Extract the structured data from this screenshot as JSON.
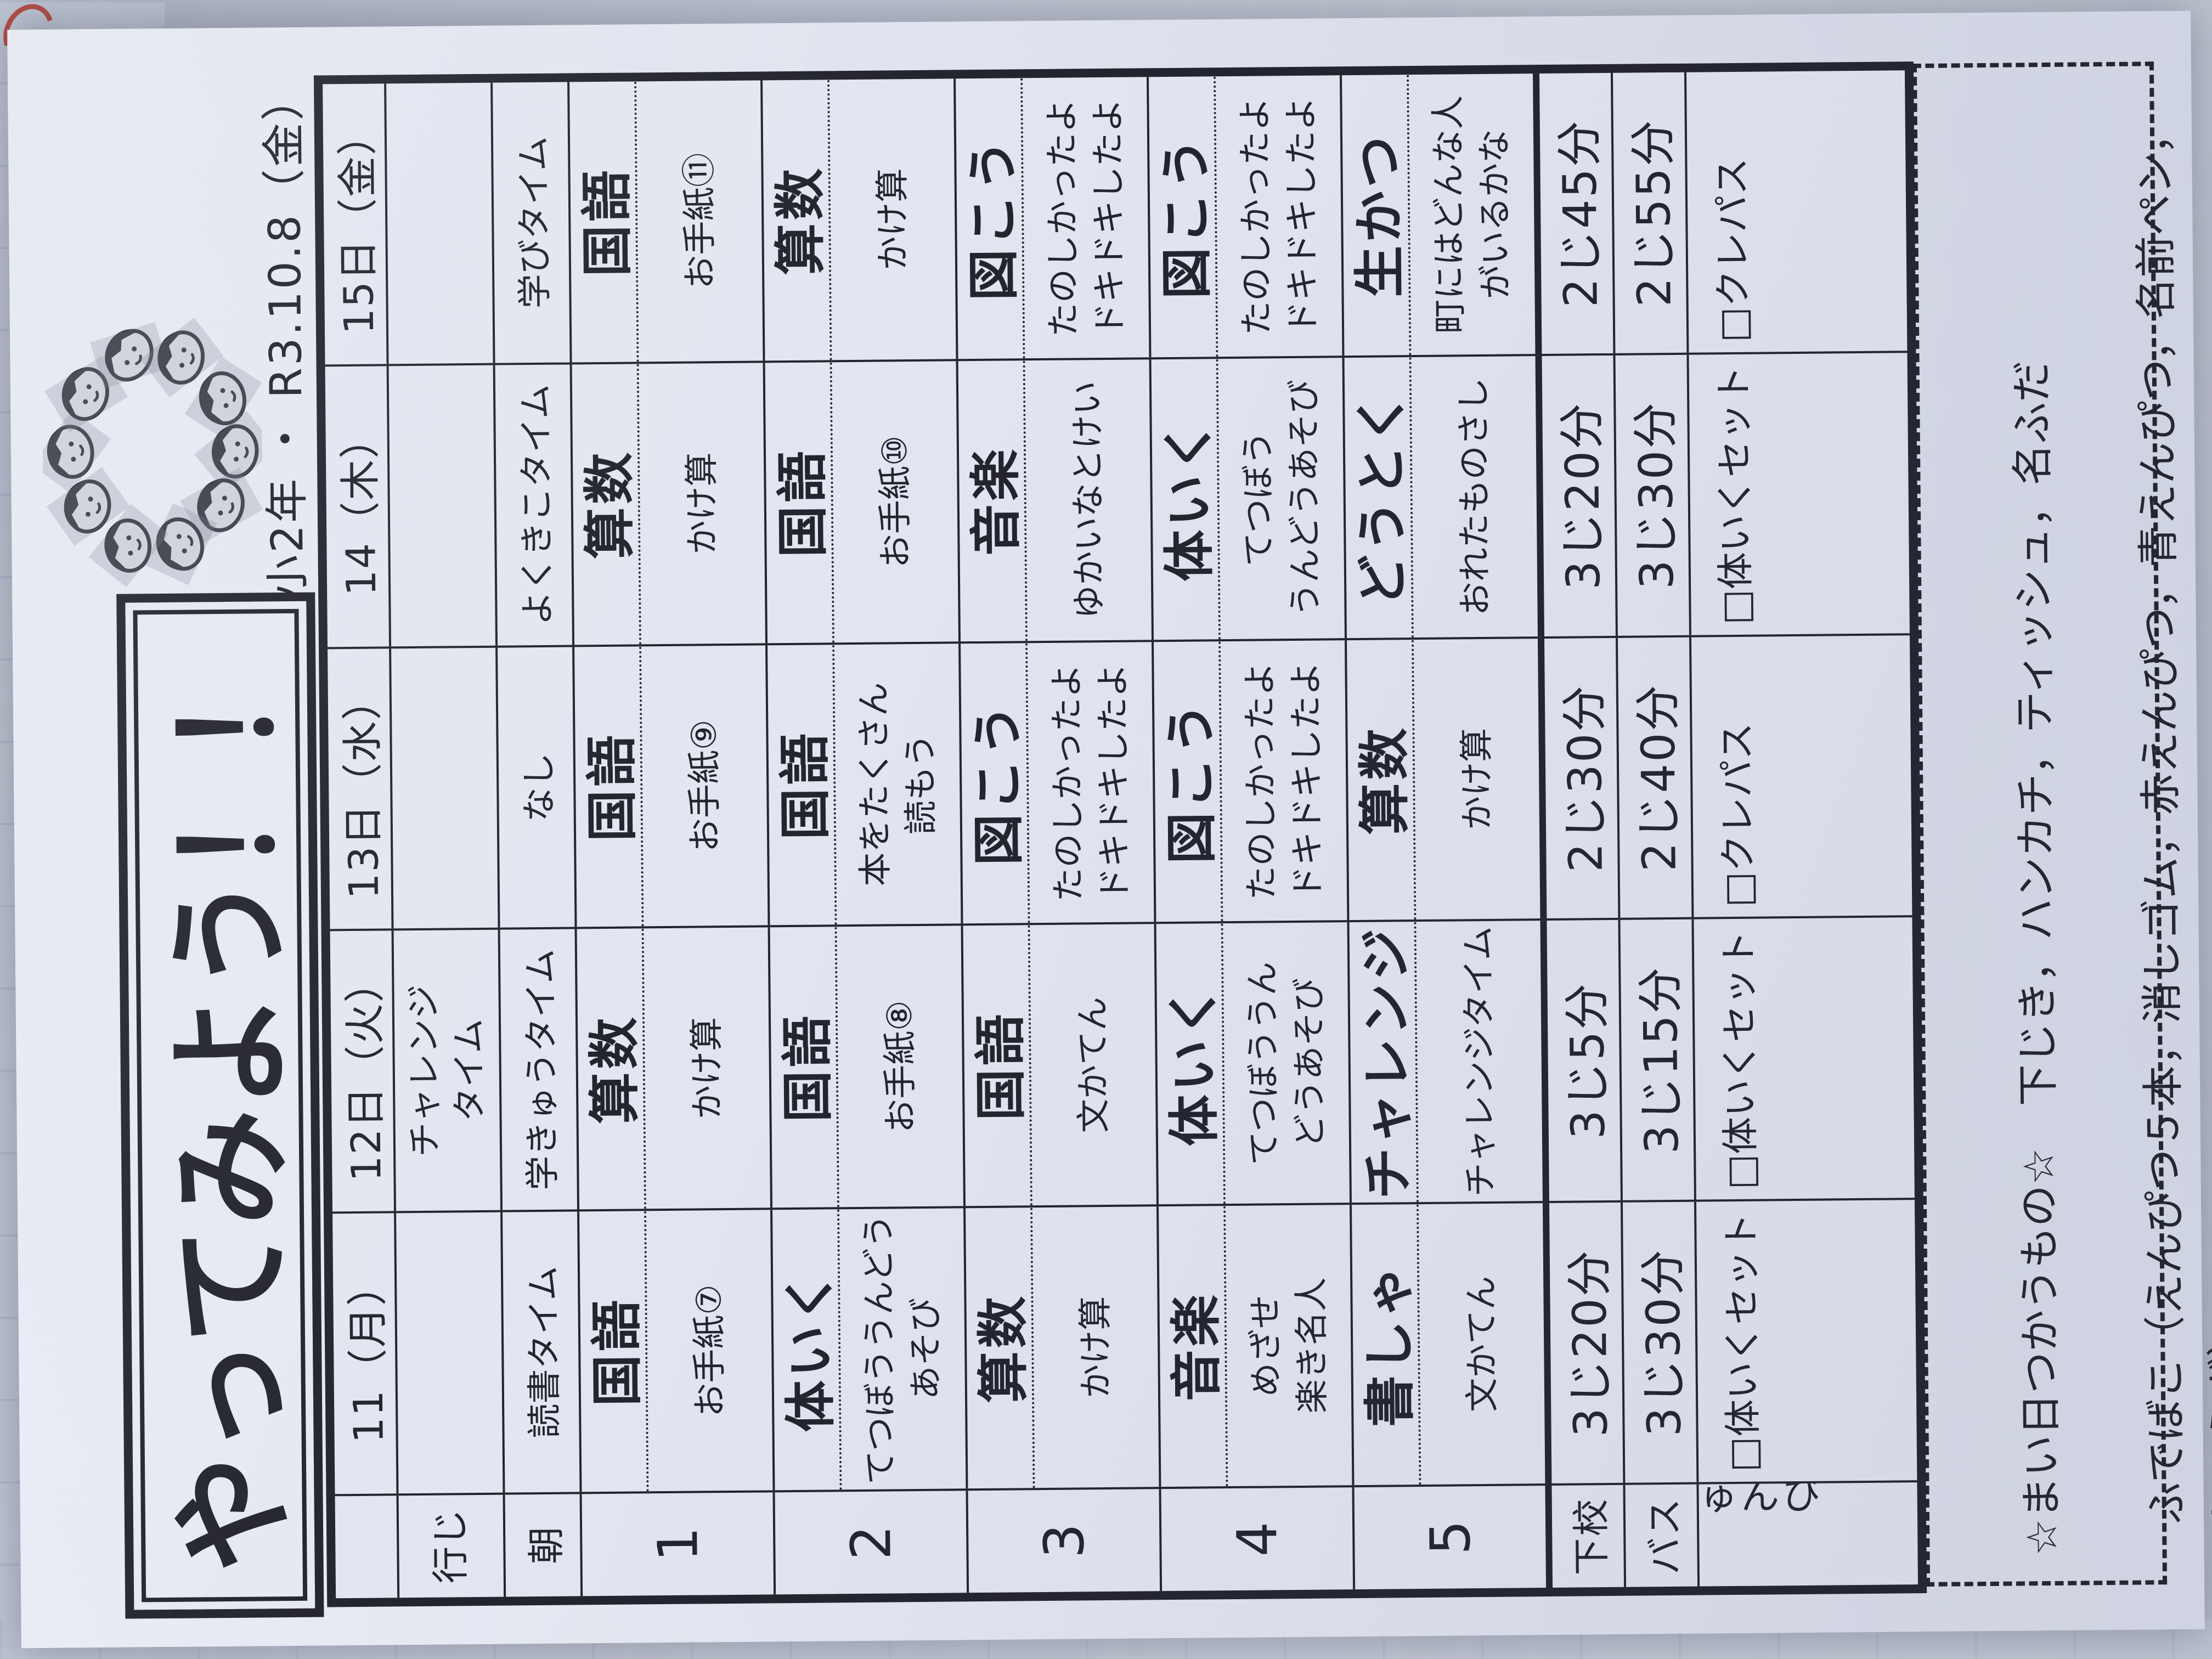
{
  "page": {
    "title": "やってみよう！！",
    "school_line": "本渡東小2年 ・ R3.10.8（金）",
    "logo_icon": "kids-faces-ring-icon"
  },
  "table": {
    "corner_label": "",
    "row_headers": [
      "行じ",
      "朝",
      "1",
      "2",
      "3",
      "4",
      "5",
      "下校",
      "バス",
      "じゅんび"
    ],
    "days": [
      {
        "label": "11（月）",
        "gyoji": "",
        "asa": "読書タイム",
        "periods": [
          {
            "subject": "国語",
            "detail": "お手紙⑦"
          },
          {
            "subject": "体いく",
            "detail": "てつぼううんどう\nあそび"
          },
          {
            "subject": "算数",
            "detail": "かけ算"
          },
          {
            "subject": "音楽",
            "detail": "めざせ\n楽き名人"
          },
          {
            "subject": "書しゃ",
            "detail": "文かてん"
          }
        ],
        "gekou": "3じ20分",
        "bus": "3じ30分",
        "junbi": "□体いくセット"
      },
      {
        "label": "12日（火）",
        "gyoji": "チャレンジ\nタイム",
        "asa": "学きゅうタイム",
        "periods": [
          {
            "subject": "算数",
            "detail": "かけ算"
          },
          {
            "subject": "国語",
            "detail": "お手紙⑧"
          },
          {
            "subject": "国語",
            "detail": "文かてん"
          },
          {
            "subject": "体いく",
            "detail": "てつぼううん\nどうあそび"
          },
          {
            "subject": "チャレンジ",
            "detail": "チャレンジタイム"
          }
        ],
        "gekou": "3じ5分",
        "bus": "3じ15分",
        "junbi": "□体いくセット"
      },
      {
        "label": "13日（水）",
        "gyoji": "",
        "asa": "なし",
        "periods": [
          {
            "subject": "国語",
            "detail": "お手紙⑨"
          },
          {
            "subject": "国語",
            "detail": "本をたくさん\n読もう"
          },
          {
            "subject": "図こう",
            "detail": "たのしかったよ\nドキドキしたよ"
          },
          {
            "subject": "図こう",
            "detail": "たのしかったよ\nドキドキしたよ"
          },
          {
            "subject": "算数",
            "detail": "かけ算"
          }
        ],
        "gekou": "2じ30分",
        "bus": "2じ40分",
        "junbi": "□クレパス"
      },
      {
        "label": "14（木）",
        "gyoji": "",
        "asa": "よくきこタイム",
        "periods": [
          {
            "subject": "算数",
            "detail": "かけ算"
          },
          {
            "subject": "国語",
            "detail": "お手紙⑩"
          },
          {
            "subject": "音楽",
            "detail": "ゆかいなとけい"
          },
          {
            "subject": "体いく",
            "detail": "てつぼう\nうんどうあそび"
          },
          {
            "subject": "どうとく",
            "detail": "おれたものさし"
          }
        ],
        "gekou": "3じ20分",
        "bus": "3じ30分",
        "junbi": "□体いくセット"
      },
      {
        "label": "15日（金）",
        "gyoji": "",
        "asa": "学びタイム",
        "periods": [
          {
            "subject": "国語",
            "detail": "お手紙⑪"
          },
          {
            "subject": "算数",
            "detail": "かけ算"
          },
          {
            "subject": "図こう",
            "detail": "たのしかったよ\nドキドキしたよ"
          },
          {
            "subject": "図こう",
            "detail": "たのしかったよ\nドキドキしたよ"
          },
          {
            "subject": "生かつ",
            "detail": "町にはどんな人\nがいるかな"
          }
        ],
        "gekou": "2じ45分",
        "bus": "2じ55分",
        "junbi": "□クレパス"
      }
    ]
  },
  "notes": {
    "line1": "☆まい日つかうもの☆　下じき，ハンカチ，ティッシュ，名ふだ",
    "line2": "ふでばこ（えんぴつ５本，消しゴム，赤えんぴつ，青えんぴつ，名前ペン，じょうぎ）",
    "line3": "☆月よう日（しゅうはじめ）☆　マスク，上ぐつ，はブラシ・コップ"
  },
  "colors": {
    "paper": "#e2e5ef",
    "ink": "#23242e",
    "background": "#bcc2cf",
    "red_mark": "#b23a31"
  }
}
